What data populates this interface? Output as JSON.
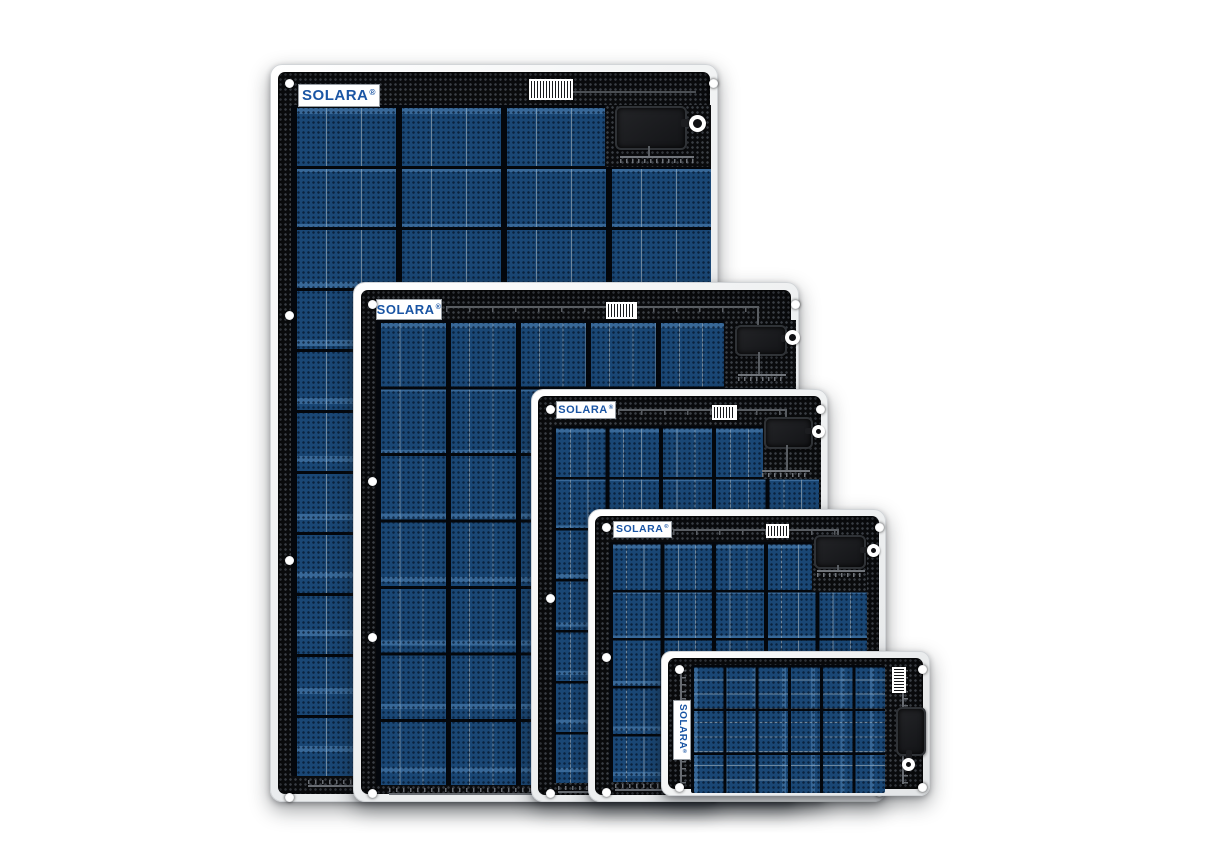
{
  "brand": {
    "name": "SOLARA",
    "registered": "®",
    "logo_text_color": "#1a55a4",
    "logo_background": "#ffffff"
  },
  "scene": {
    "type": "product-image",
    "subject": "SOLARA flexible solar panel product family",
    "background_color": "#ffffff",
    "panel_count": 5,
    "arrangement": "overlapping panels, largest at rear-left to smallest at front-right, bottom-aligned"
  },
  "colors": {
    "panel_body_black": "#0a0b0d",
    "dot_texture_gray": "#3a3e45",
    "cell_blue": "#1a4775",
    "cell_highlight_blue": "#78afd1",
    "cell_wire_gray": "#a2aeb6",
    "frame_white": "#f2f4f5",
    "bus_wire_gray": "#70747a",
    "junction_box_black": "#1b1c1f"
  },
  "panels": [
    {
      "id": "panel-1",
      "size_rank": 1,
      "orientation": "portrait",
      "logo": "SOLARA®",
      "cell_columns": 4,
      "cell_rows": 11,
      "features": [
        "mounting-eyelets",
        "barcode-sticker",
        "junction-box",
        "cable-loop-connector",
        "wire-bus-bars"
      ]
    },
    {
      "id": "panel-2",
      "size_rank": 2,
      "orientation": "portrait",
      "logo": "SOLARA®",
      "cell_columns": 6,
      "cell_rows": 7,
      "features": [
        "mounting-eyelets",
        "barcode-sticker",
        "junction-box",
        "cable-loop-connector",
        "top-bus-wire",
        "wire-bus-bars"
      ]
    },
    {
      "id": "panel-3",
      "size_rank": 3,
      "orientation": "portrait",
      "logo": "SOLARA®",
      "cell_columns": 5,
      "cell_rows": 7,
      "features": [
        "mounting-eyelets",
        "barcode-sticker",
        "junction-box",
        "cable-loop-connector",
        "top-bus-wire",
        "wire-bus-bars"
      ]
    },
    {
      "id": "panel-4",
      "size_rank": 4,
      "orientation": "portrait",
      "logo": "SOLARA®",
      "cell_columns": 5,
      "cell_rows": 5,
      "features": [
        "mounting-eyelets",
        "barcode-sticker",
        "junction-box",
        "cable-loop-connector",
        "top-bus-wire",
        "wire-bus-bars"
      ]
    },
    {
      "id": "panel-5",
      "size_rank": 5,
      "orientation": "landscape",
      "logo": "SOLARA®",
      "cell_columns": 6,
      "cell_rows": 3,
      "features": [
        "mounting-eyelets",
        "vertical-barcode-sticker",
        "vertical-junction-box",
        "cable-loop-connector",
        "side-bus-wires"
      ]
    }
  ]
}
